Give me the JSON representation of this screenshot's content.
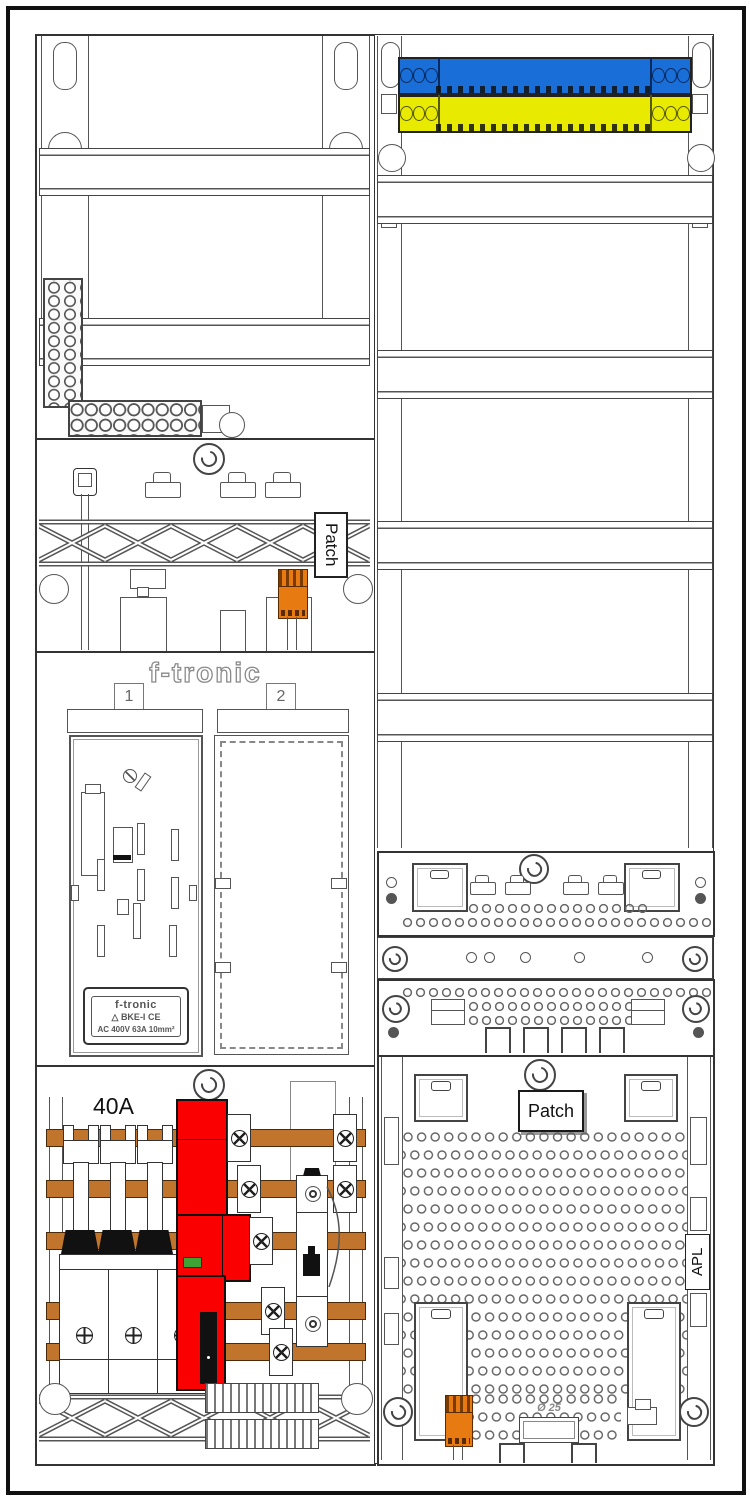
{
  "left_column": {
    "patch_label": "Patch",
    "brand": "f-tronic",
    "field1_no": "1",
    "field2_no": "2",
    "plate": {
      "brand": "f-tronic",
      "logo": "△",
      "model": "BKE-I",
      "ce": "CE",
      "ratings": "AC 400V   63A   10mm²"
    },
    "breaker_rating": "40A"
  },
  "right_column": {
    "patch_label": "Patch",
    "apl_label": "APL",
    "conduit_label": "Ø 25"
  },
  "colors": {
    "neutral_busbar_blue": "#1a6ed8",
    "pe_busbar_yellow": "#e8eb00",
    "copper_busbar": "#c1742b",
    "sls_red": "#fa0000",
    "connector_orange": "#e87a12",
    "led_green": "#3da335"
  }
}
